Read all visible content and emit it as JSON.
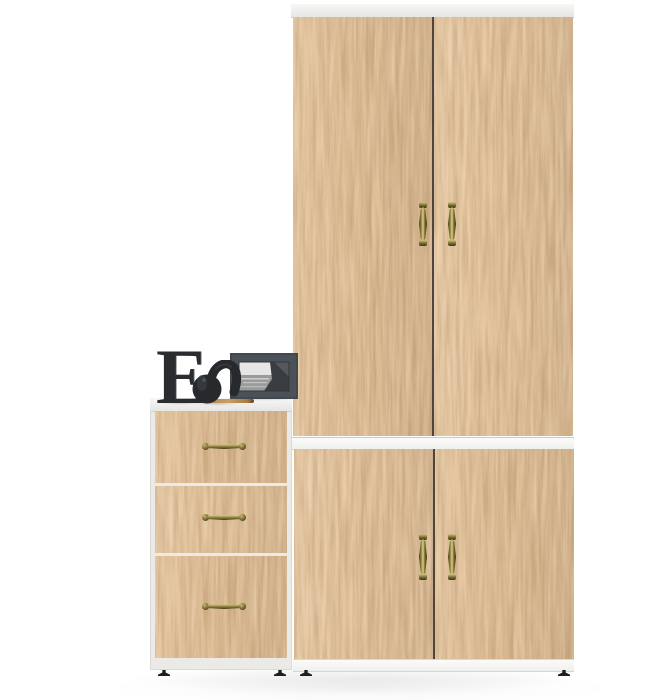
{
  "scene": {
    "type": "furniture product photo on white background",
    "items": {
      "wardrobe_upper": {
        "label": "Tall two-door wardrobe, golden oak",
        "doors": 2,
        "handle_style": "vertical antique brass pull"
      },
      "divider_band": {
        "label": "White horizontal divider band"
      },
      "cabinet_lower": {
        "label": "Two-door base cabinet, golden oak",
        "doors": 2,
        "handle_style": "vertical antique brass pull"
      },
      "drawer_chest": {
        "label": "Three-drawer chest, golden oak with white top",
        "drawers": 3,
        "handle_style": "horizontal antique brass pull"
      },
      "feet": {
        "label": "Small black adjustable feet",
        "count": 4
      }
    },
    "decor": {
      "letter_text": "E",
      "letter_label": "Dark decorative serif letter",
      "figurine_label": "Dark glossy elephant figurine with raised trunk",
      "frame_label": "Dark gray photo frame with black-and-white mountain landscape",
      "stick_label": "Small wooden tray stick"
    },
    "colors": {
      "background": "#ffffff",
      "wood_light": "#dfb37a",
      "wood_mid": "#bf8e5b",
      "wood_dark": "#805126",
      "edge_white": "#f4f4f2",
      "brass": "#9a8b45",
      "brass_light": "#ddd088",
      "brass_dark": "#3e3715",
      "decor_dark": "#2a2c30",
      "frame_gray": "#4b5158",
      "feet_black": "#1d1e1f"
    }
  }
}
